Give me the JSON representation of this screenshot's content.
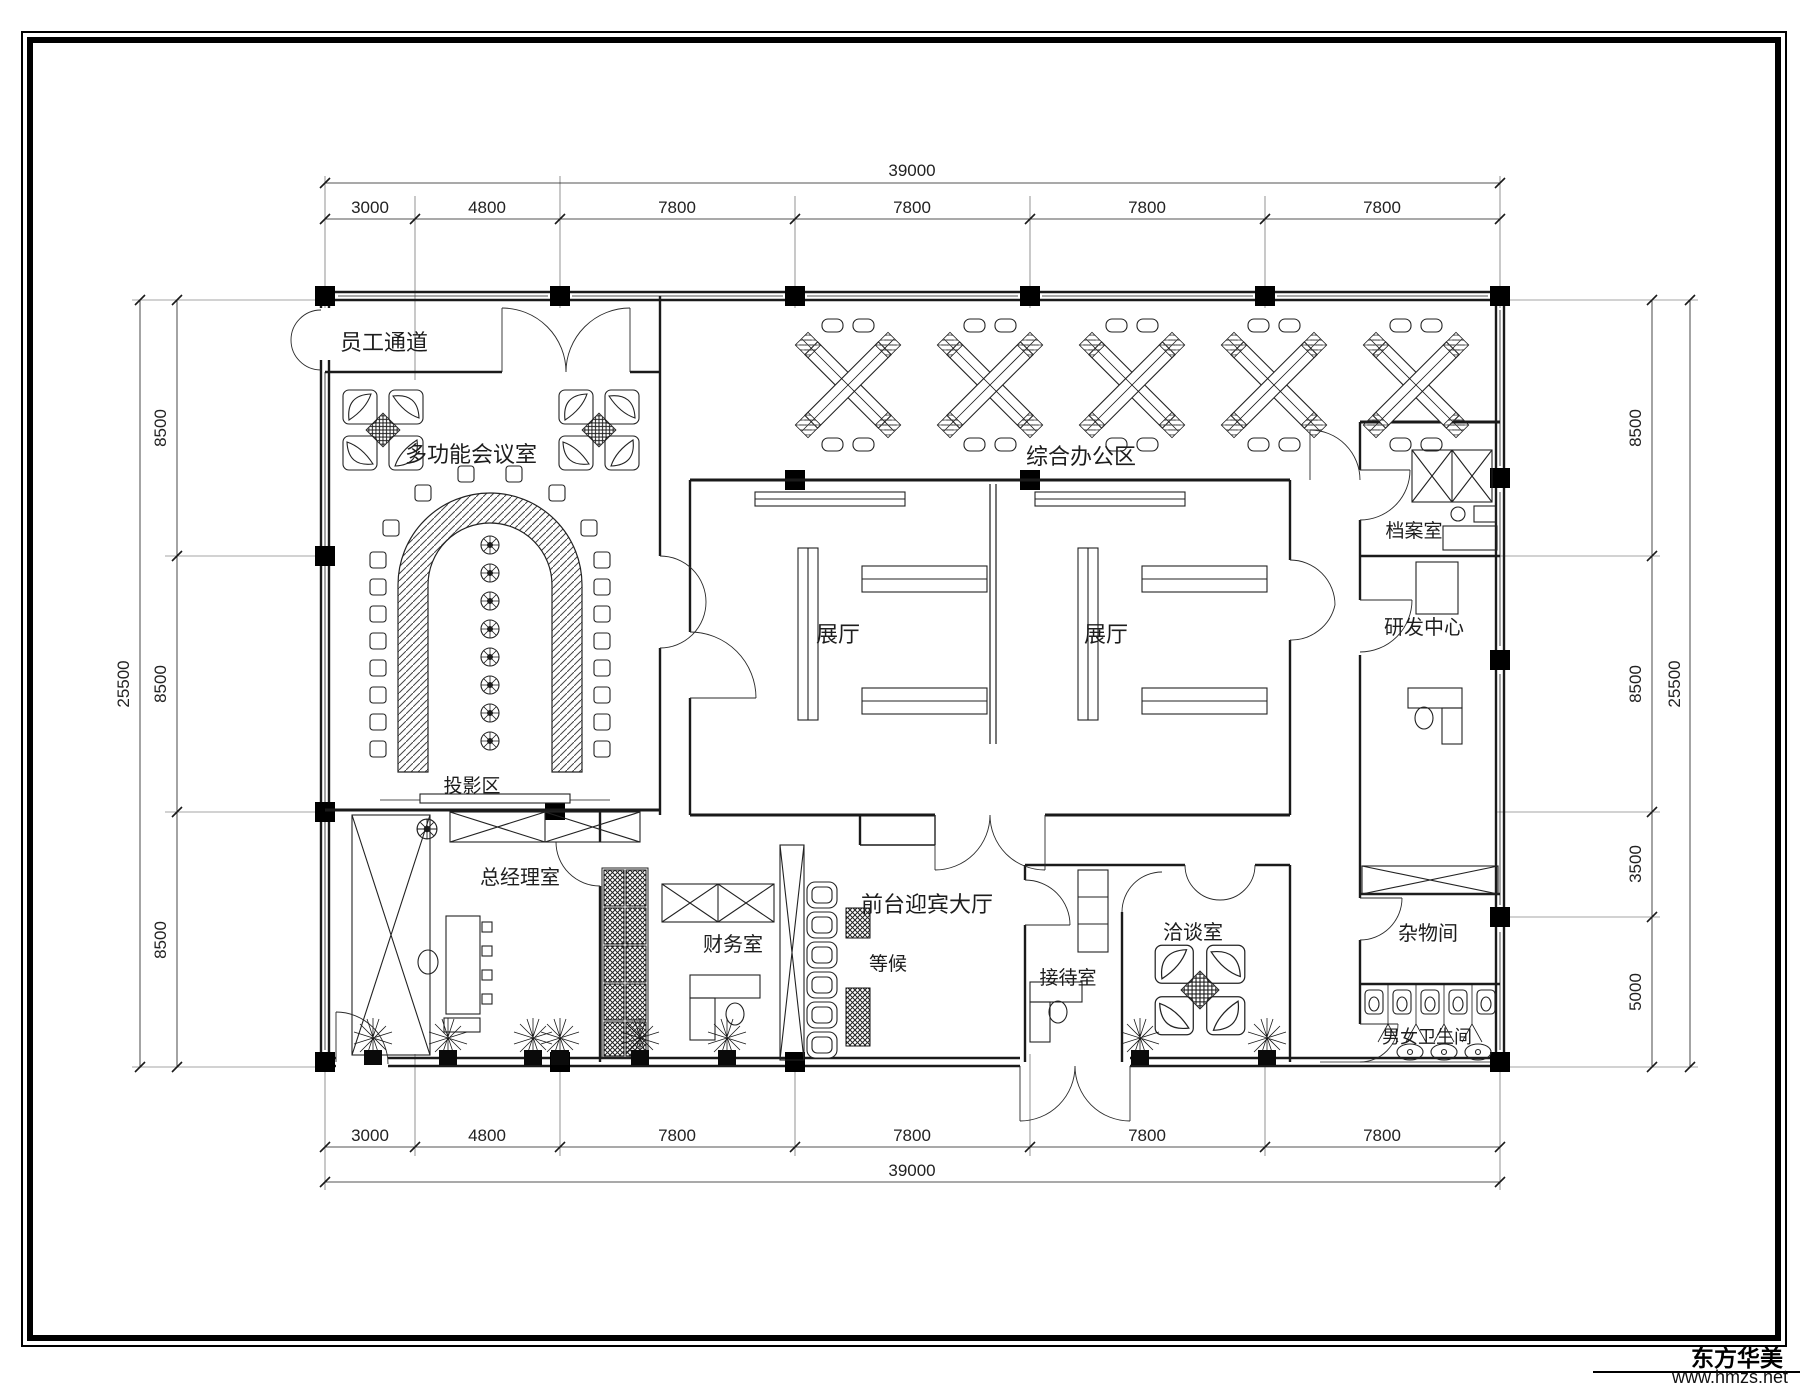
{
  "drawing": {
    "rooms": {
      "staff_corridor": "员工通道",
      "multifunction_meeting": "多功能会议室",
      "general_office": "综合办公区",
      "exhibition_left": "展厅",
      "exhibition_right": "展厅",
      "archive": "档案室",
      "rnd_center": "研发中心",
      "projection": "投影区",
      "general_manager": "总经理室",
      "finance": "财务室",
      "waiting": "等候",
      "front_lobby": "前台迎宾大厅",
      "reception": "接待室",
      "negotiation": "洽谈室",
      "utility": "杂物间",
      "restrooms": "男女卫生间"
    },
    "dimensions": {
      "top": {
        "total": "39000",
        "segments": [
          "3000",
          "4800",
          "7800",
          "7800",
          "7800",
          "7800"
        ]
      },
      "bottom": {
        "total": "39000",
        "segments": [
          "3000",
          "4800",
          "7800",
          "7800",
          "7800",
          "7800"
        ]
      },
      "left": {
        "total": "25500",
        "segments": [
          "8500",
          "8500",
          "8500"
        ]
      },
      "right": {
        "total": "25500",
        "segments": [
          "8500",
          "8500",
          "3500",
          "5000"
        ]
      }
    },
    "watermark": {
      "brand": "东方华美",
      "website": "www.hmzs.net"
    },
    "colors": {
      "ink": "#1a1a1a",
      "paper": "#ffffff"
    }
  }
}
